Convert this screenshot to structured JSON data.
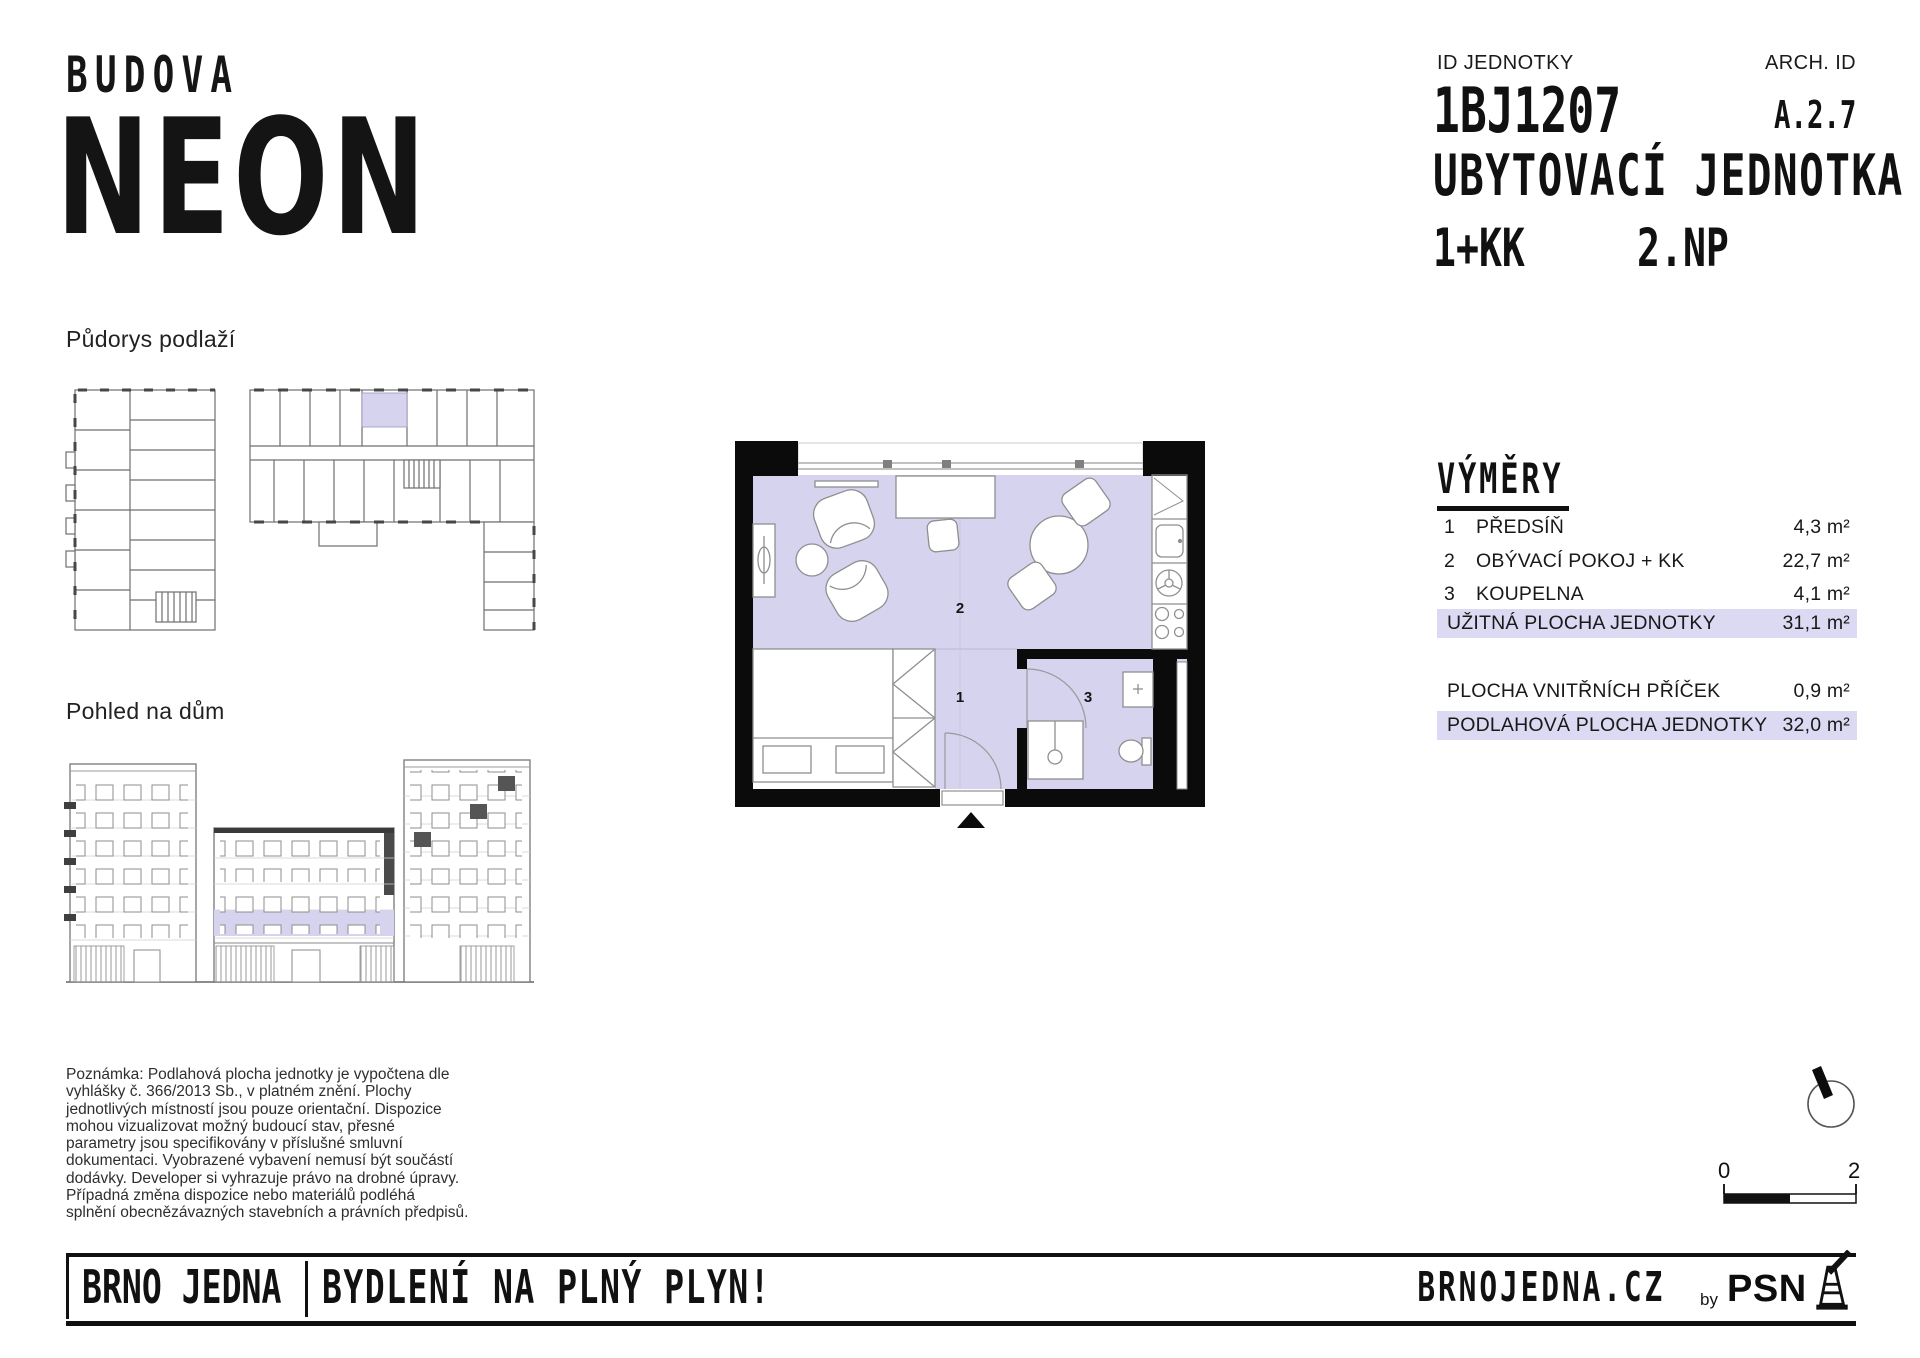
{
  "logo": {
    "top": "BUDOVA",
    "name": "NEON"
  },
  "header": {
    "id_label": "ID JEDNOTKY",
    "id_value": "1BJ1207",
    "arch_label": "ARCH. ID",
    "arch_value": "A.2.7",
    "unit_type": "UBYTOVACÍ JEDNOTKA",
    "disposition": "1+KK",
    "floor": "2.NP"
  },
  "sections": {
    "floorplan_overview_label": "Půdorys podlaží",
    "building_view_label": "Pohled na dům"
  },
  "plan": {
    "rooms": [
      "1",
      "2",
      "3"
    ]
  },
  "areas": {
    "title": "VÝMĚRY",
    "rows": [
      {
        "num": "1",
        "name": "PŘEDSÍŇ",
        "value": "4,3 m²"
      },
      {
        "num": "2",
        "name": "OBÝVACÍ POKOJ + KK",
        "value": "22,7 m²"
      },
      {
        "num": "3",
        "name": "KOUPELNA",
        "value": "4,1 m²"
      }
    ],
    "usable": {
      "name": "UŽITNÁ PLOCHA JEDNOTKY",
      "value": "31,1 m²"
    },
    "partitions": {
      "name": "PLOCHA VNITŘNÍCH PŘÍČEK",
      "value": "0,9 m²"
    },
    "floor_area": {
      "name": "PODLAHOVÁ PLOCHA JEDNOTKY",
      "value": "32,0 m²"
    }
  },
  "note": "Poznámka: Podlahová plocha jednotky je vypočtena dle\nvyhlášky č. 366/2013 Sb., v platném znění. Plochy\njednotlivých místností jsou pouze orientační. Dispozice\nmohou vizualizovat možný budoucí stav, přesné\nparametry jsou specifikovány v příslušné smluvní\ndokumentaci. Vyobrazené vybavení nemusí být součástí\ndodávky. Developer si vyhrazuje právo na drobné úpravy.\nPřípadná změna dispozice nebo materiálů podléhá\nsplnění obecnězávazných stavebních a právních předpisů.",
  "scalebar": {
    "start": "0",
    "end": "2"
  },
  "footer": {
    "brand": "BRNO JEDNA",
    "slogan": "BYDLENÍ NA PLNÝ PLYN!",
    "website": "BRNOJEDNA.CZ",
    "by_label": "by",
    "company": "PSN"
  },
  "colors": {
    "unit_fill": "#d6d3ef",
    "row_highlight": "#dcd9f2",
    "ink": "#0f0f0f"
  }
}
